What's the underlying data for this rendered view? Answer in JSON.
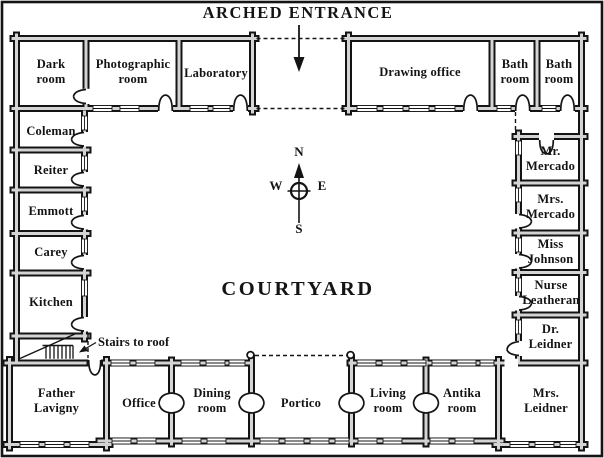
{
  "title": "ARCHED ENTRANCE",
  "courtyard": "COURTYARD",
  "stairs_note": "Stairs to roof",
  "compass": {
    "n": "N",
    "e": "E",
    "s": "S",
    "w": "W"
  },
  "rooms": {
    "dark_room": "Dark room",
    "photographic_room": "Photographic room",
    "laboratory": "Laboratory",
    "drawing_office": "Drawing office",
    "bath_room_1": "Bath room",
    "bath_room_2": "Bath room",
    "coleman": "Coleman",
    "reiter": "Reiter",
    "emmott": "Emmott",
    "carey": "Carey",
    "kitchen": "Kitchen",
    "mr_mercado": "Mr. Mercado",
    "mrs_mercado": "Mrs. Mercado",
    "miss_johnson": "Miss Johnson",
    "nurse_leatheran": "Nurse Leatheran",
    "dr_leidner": "Dr. Leidner",
    "father_lavigny": "Father Lavigny",
    "office": "Office",
    "dining_room": "Dining room",
    "portico": "Portico",
    "living_room": "Living room",
    "antika_room": "Antika room",
    "mrs_leidner": "Mrs. Leidner"
  },
  "colors": {
    "wall": "#141414",
    "wall_channel": "#d4d4d4",
    "background": "#ffffff",
    "text": "#141414"
  }
}
